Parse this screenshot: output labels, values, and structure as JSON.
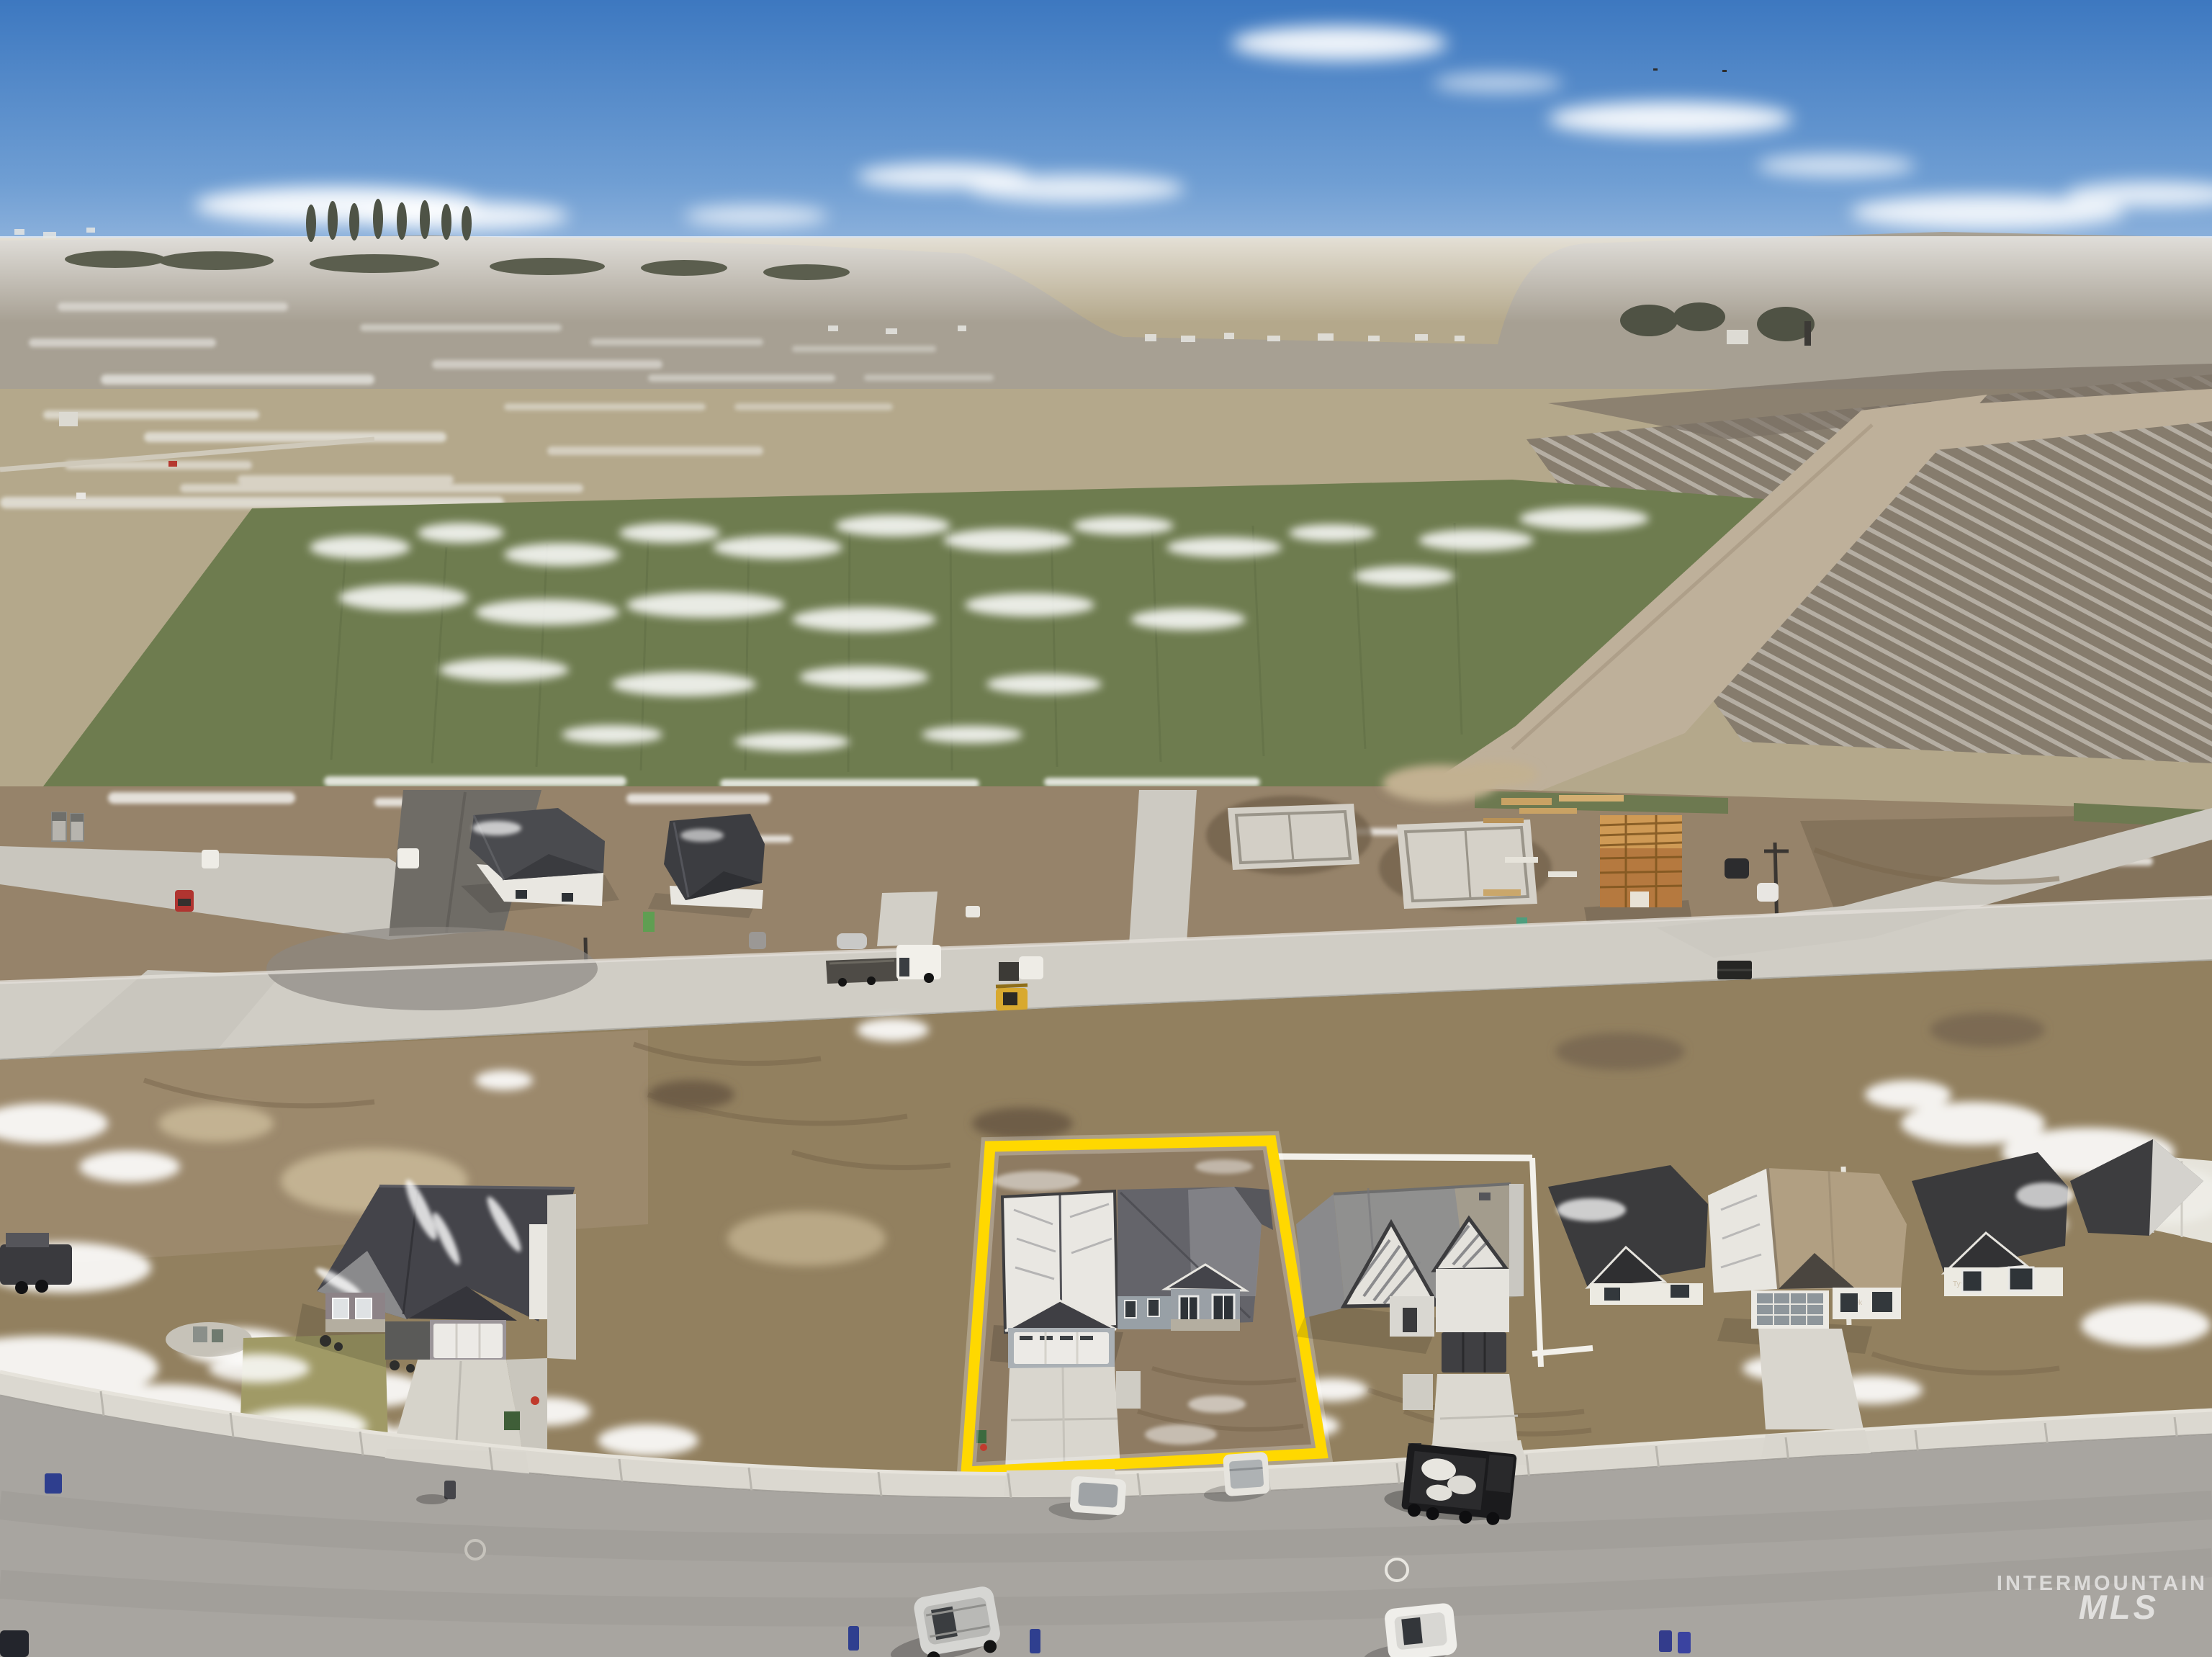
{
  "image": {
    "type": "aerial-drone-photo",
    "subject": "new construction single-family home on highlighted lot",
    "setting": "rural subdivision under construction, winter with patchy snow, farm fields and blue sky behind"
  },
  "watermark": {
    "line1": "INTERMOUNTAIN",
    "line2": "MLS"
  },
  "highlight": {
    "name": "subject-property-boundary",
    "shape": "quadrilateral",
    "color": "#ffd800"
  },
  "construction_wrap_label": "Tyvek",
  "colors": {
    "accent_yellow": "#ffd800",
    "sky_top": "#3d78c0",
    "sky_horizon": "#dfe8f2",
    "cloud_white": "#ffffff",
    "distant_land": "#a7a093",
    "field_tan": "#b4a88b",
    "field_green": "#6e7c4f",
    "field_plowed": "#867c6d",
    "dirt_road": "#beb09a",
    "dirt_construction": "#96836a",
    "dirt_lots": "#92805f",
    "road_concrete": "#d0cdc5",
    "road_asphalt": "#6f6c66",
    "street_asphalt": "#a8a5a0",
    "sidewalk": "#dbd8d0",
    "snow": "#efeeea",
    "roof_dark": "#3e3e40",
    "roof_gray": "#8e8e90",
    "roof_tan": "#b19f82",
    "wall_white": "#eceae4",
    "wall_gray": "#9aa0a6",
    "lawn": "#a09a66",
    "watermark_white": "#ffffff"
  },
  "scene_objects": [
    "sky-with-clouds",
    "distant-farmland-horizon",
    "snow-streaked-tan-field",
    "green-winter-wheat-field",
    "plowed-field-with-snow-rows",
    "diagonal-dirt-road",
    "construction-row-homes",
    "concrete-foundations",
    "wood-framed-house",
    "construction-road",
    "subject-home-gray-with-snowy-roof",
    "yellow-property-outline",
    "neighbor-homes",
    "residential-street",
    "sidewalk",
    "vehicles-and-trailers",
    "trash-bins",
    "mls-watermark"
  ]
}
